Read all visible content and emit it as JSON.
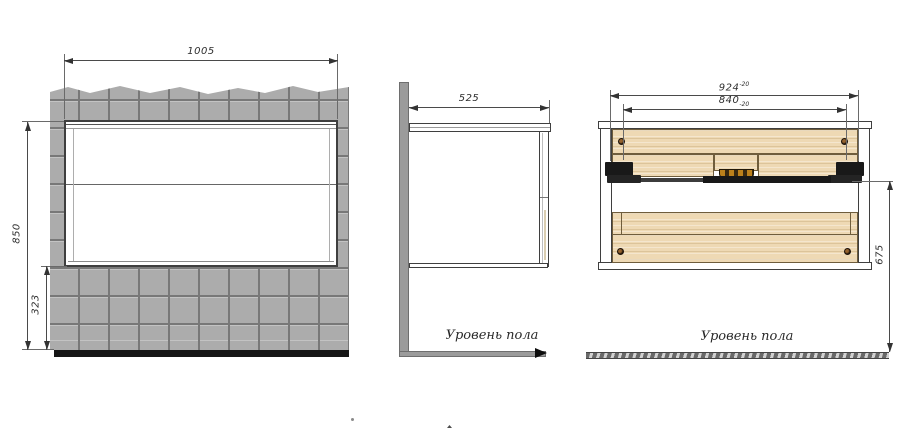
{
  "labels": {
    "floor_level": "Уровень пола"
  },
  "dimensions": {
    "niche_width": "1005",
    "cabinet_height": "850",
    "bottom_clearance": "323",
    "depth": "525",
    "overall_width": "924",
    "overall_width_tol": "-20",
    "drawer_width": "840",
    "drawer_width_tol": "-20",
    "underside_height": "675"
  },
  "colors": {
    "tile": "#acacac",
    "grout": "#787878",
    "wood": "#eed9b4",
    "hardware": "#191919",
    "drain_accent": "#bc811c",
    "line": "#4a4a4a"
  }
}
